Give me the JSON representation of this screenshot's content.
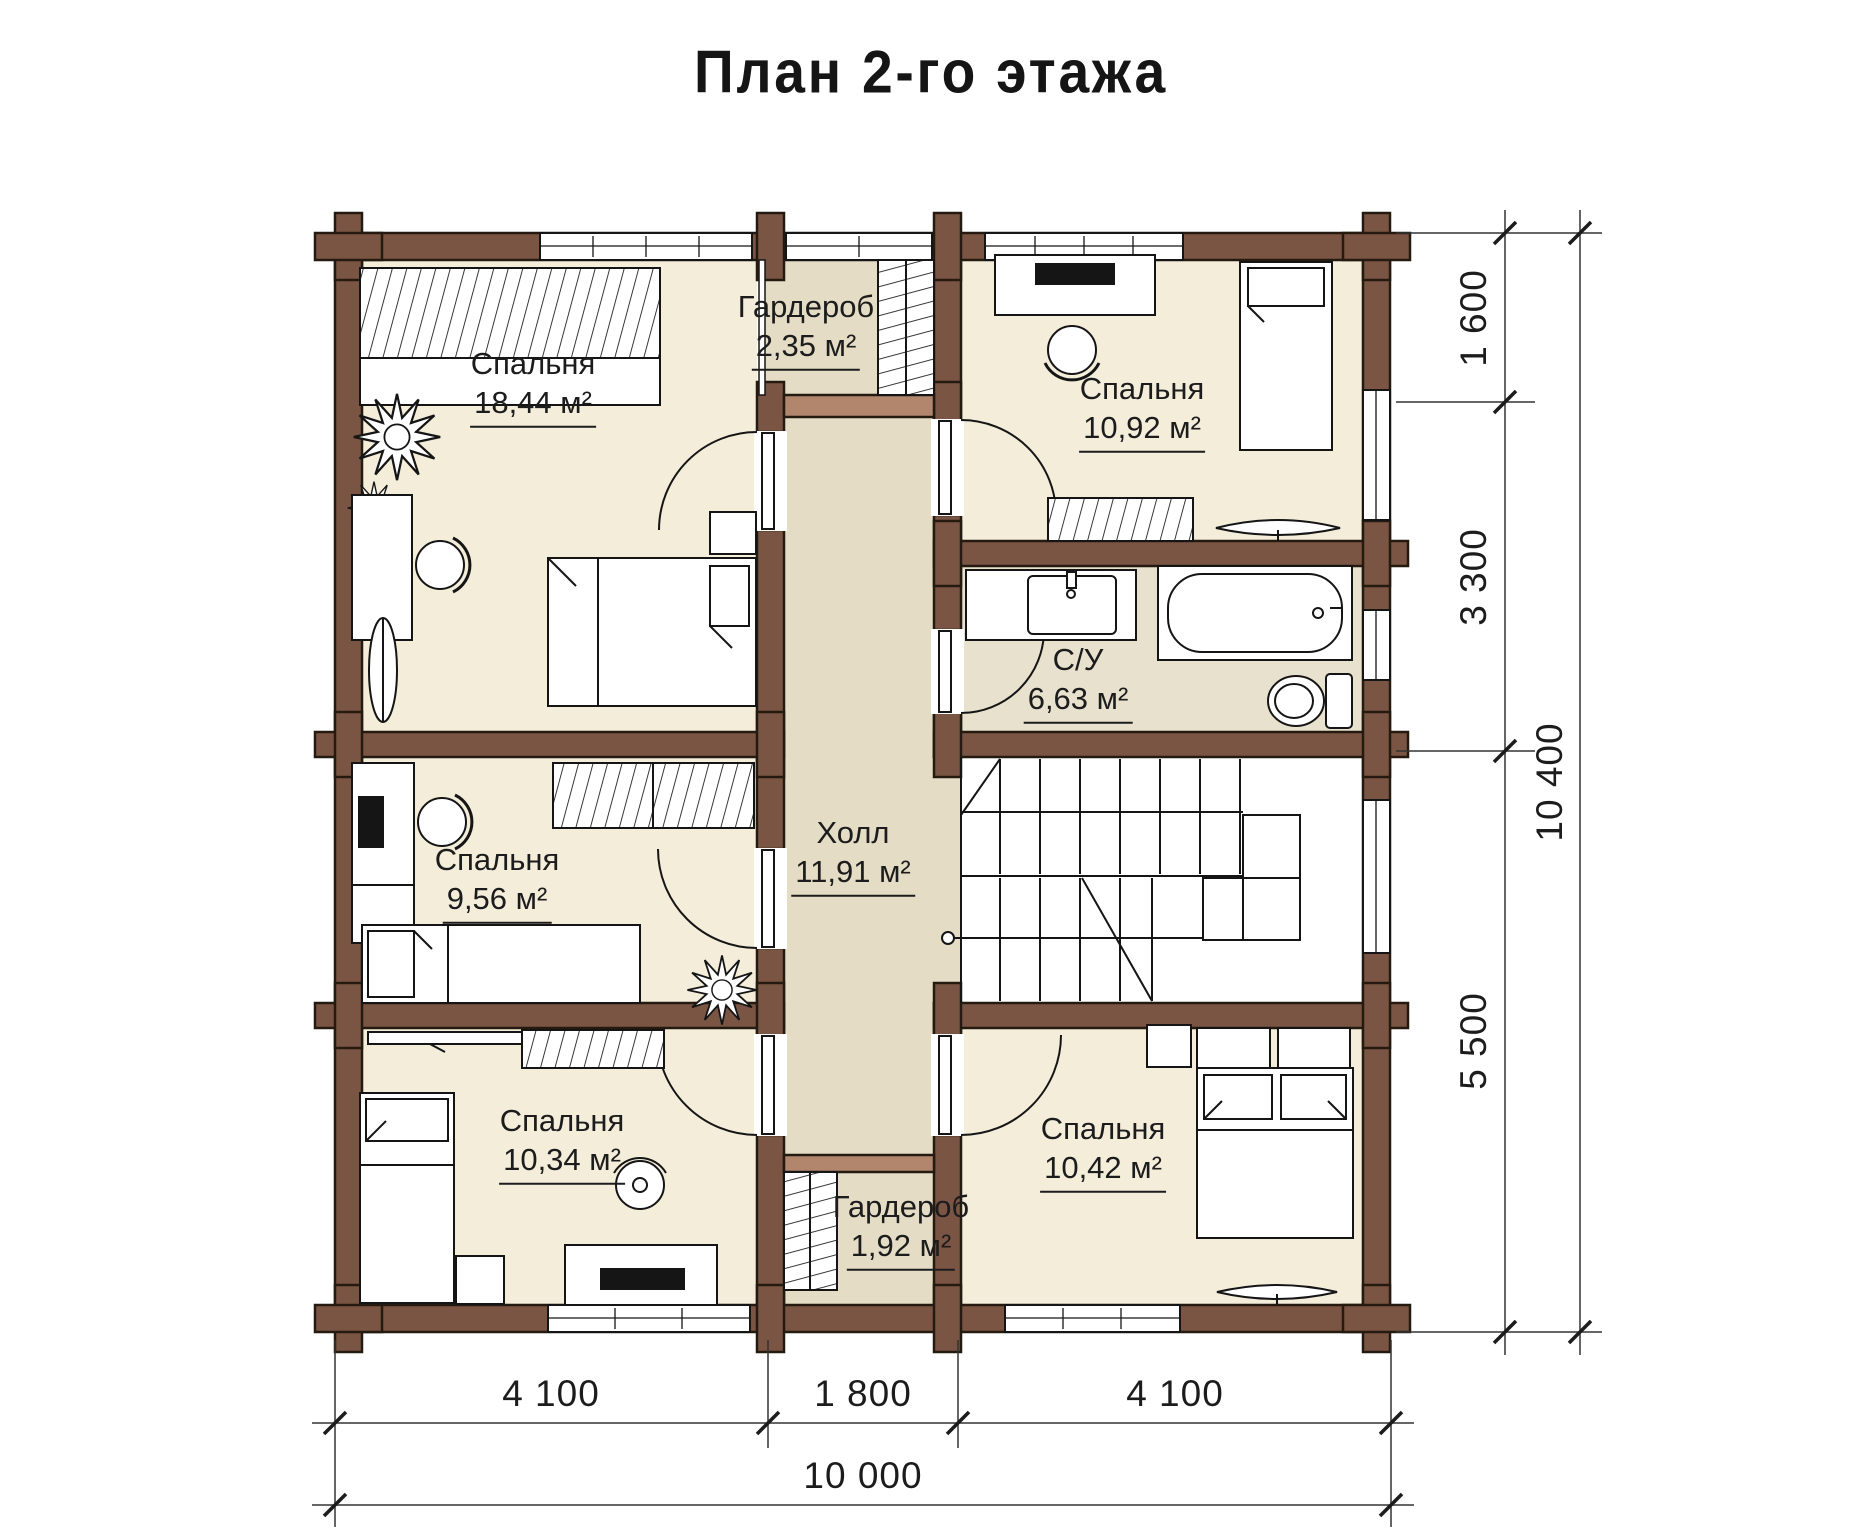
{
  "title": "План 2-го этажа",
  "plan": {
    "rooms": [
      {
        "id": "bedroom-18-44",
        "name": "Спальня",
        "area": "18,44 м²"
      },
      {
        "id": "wardrobe-top",
        "name": "Гардероб",
        "area": "2,35 м²"
      },
      {
        "id": "bedroom-10-92",
        "name": "Спальня",
        "area": "10,92 м²"
      },
      {
        "id": "bathroom",
        "name": "С/У",
        "area": "6,63 м²"
      },
      {
        "id": "bedroom-9-56",
        "name": "Спальня",
        "area": "9,56 м²"
      },
      {
        "id": "hall",
        "name": "Холл",
        "area": "11,91 м²"
      },
      {
        "id": "bedroom-10-34",
        "name": "Спальня",
        "area": "10,34 м²"
      },
      {
        "id": "wardrobe-bottom",
        "name": "Гардероб",
        "area": "1,92 м²"
      },
      {
        "id": "bedroom-10-42",
        "name": "Спальня",
        "area": "10,42 м²"
      }
    ],
    "dimensions": {
      "right": [
        "1 600",
        "3 300",
        "5 500"
      ],
      "right_total": "10 400",
      "bottom": [
        "4 100",
        "1 800",
        "4 100"
      ],
      "bottom_total": "10 000"
    }
  },
  "colors": {
    "wall": "#7b5544",
    "partition": "#b2866d",
    "room_floor": "#f3edda",
    "hall_floor": "#e4dcc5",
    "bath_floor": "#e8e1cd",
    "line": "#1a1a1a",
    "background": "#ffffff"
  }
}
